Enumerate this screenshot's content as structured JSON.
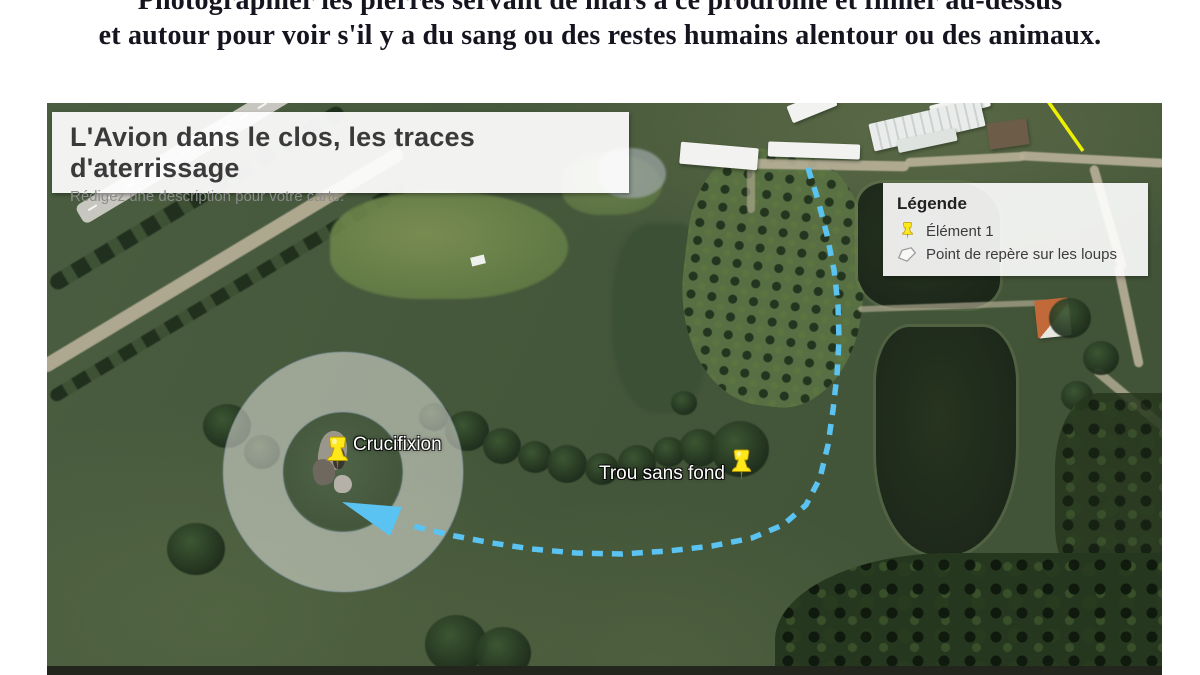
{
  "header": {
    "line1": "Photographier les pierres servant de mars à ce prodrome et filmer au-dessus",
    "line2": "et autour pour voir s'il y a du sang ou des restes humains alentour ou des animaux."
  },
  "map": {
    "title_card": {
      "title": "L'Avion dans le clos, les traces d'aterrissage",
      "subtitle": "Rédigez une description pour votre carte."
    },
    "legend": {
      "title": "Légende",
      "items": [
        {
          "icon": "pushpin-icon",
          "label": "Élément 1"
        },
        {
          "icon": "polygon-icon",
          "label": "Point de repère sur les loups"
        }
      ]
    },
    "markers": [
      {
        "label": "Crucifixion"
      },
      {
        "label": "Trou sans fond"
      }
    ],
    "colors": {
      "route_blue": "#5ac3f2",
      "pin_yellow": "#ffe81a",
      "yellow_line": "#eef000",
      "circle_fill": "rgba(228,227,222,0.55)"
    }
  }
}
